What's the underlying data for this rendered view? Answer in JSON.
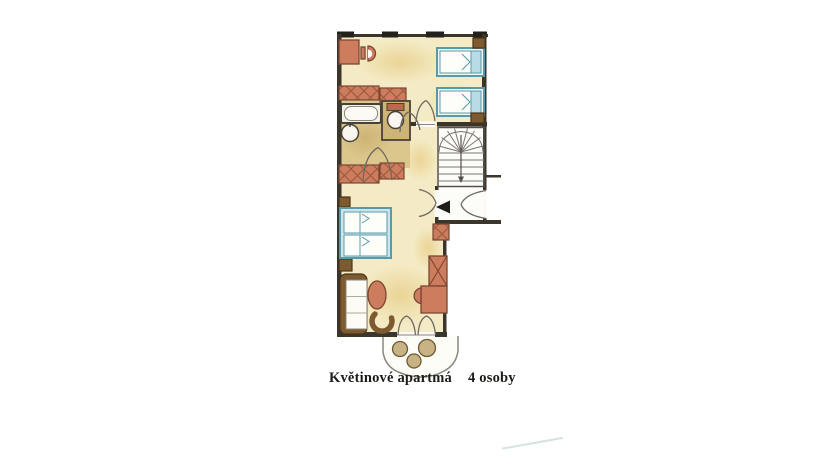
{
  "caption": {
    "apartment_name": "Květinové apartmá",
    "capacity": "4 osoby"
  },
  "colors": {
    "paper": "#ffffff",
    "wall": "#3b362c",
    "furniture_red": "#cd7c5e",
    "hatch_line": "#9a583d",
    "furniture_brown": "#7d5a2f",
    "bed_frame": "#579aab",
    "bed_fill": "#cde4ec",
    "floor": "#f4ebc6",
    "floor_bathroom": "#dbc68b",
    "floor_wc": "#cdb577",
    "stair_line": "#7a766e",
    "faint_line": "#cddfda"
  },
  "plan": {
    "type": "floor-plan",
    "rooms": [
      "bedroom",
      "bathroom",
      "wc",
      "hall",
      "staircase",
      "living-room",
      "kitchenette",
      "balcony"
    ]
  }
}
